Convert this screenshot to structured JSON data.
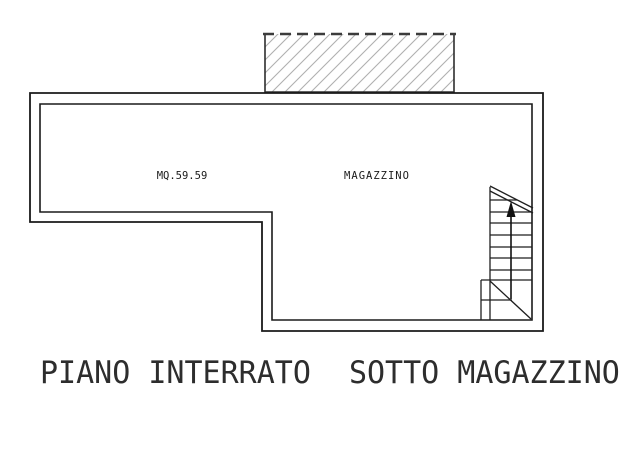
{
  "plan": {
    "area_label": "MQ.59.59",
    "room_label": "MAGAZZINO"
  },
  "title": {
    "part1": "PIANO INTERRATO",
    "part2": "SOTTO MAGAZZINO"
  },
  "icons": {
    "stair_up_arrow": "↑"
  },
  "colors": {
    "wall_line": "#1a1a1a",
    "stair_line": "#1f1f1f",
    "hatch_line": "#b0b0b0",
    "hatch_border": "#2e2e2e",
    "dashed_line": "#3c3c3c",
    "title_text": "#2d2d2d",
    "background": "#ffffff"
  }
}
